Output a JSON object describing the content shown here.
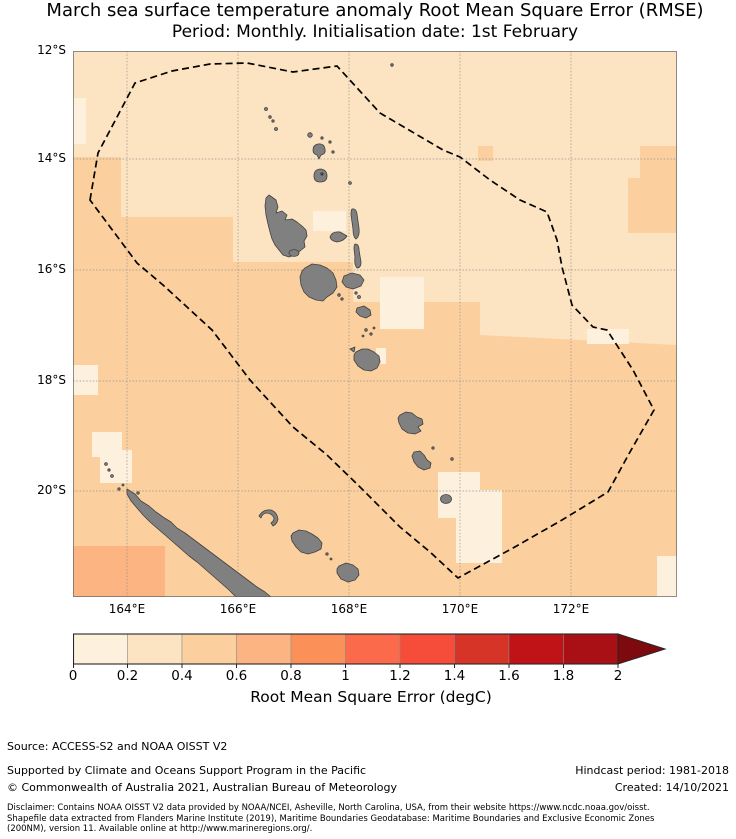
{
  "figure": {
    "title": "March sea surface temperature anomaly Root Mean Square Error (RMSE)",
    "subtitle": "Period: Monthly. Initialisation date: 1st February"
  },
  "chart_data": {
    "type": "heatmap",
    "description": "Filled gridded map of SST-anomaly hindcast RMSE (degC) around Vanuatu and New Caledonia. Land is grey; a black dashed polygon marks the Vanuatu EEZ boundary; graticule lines every 2 degrees.",
    "x_axis": {
      "label": "",
      "ticks": [
        "164°E",
        "166°E",
        "168°E",
        "170°E",
        "172°E"
      ],
      "approx_range_deg_east": [
        163.0,
        173.9
      ],
      "grid": true
    },
    "y_axis": {
      "label": "",
      "ticks": [
        "12°S",
        "14°S",
        "16°S",
        "18°S",
        "20°S"
      ],
      "approx_range_deg_south": [
        12.0,
        21.9
      ],
      "grid": true
    },
    "colorbar": {
      "label": "Root Mean Square Error (degC)",
      "tick_labels": [
        "0",
        "0.2",
        "0.4",
        "0.6",
        "0.8",
        "1",
        "1.2",
        "1.4",
        "1.6",
        "1.8",
        "2"
      ],
      "range": [
        0,
        2
      ],
      "bin_width": 0.2,
      "orientation": "horizontal",
      "extend": "max-arrow-right",
      "bin_colors": [
        "#fdf0dd",
        "#fce3c1",
        "#fbd09e",
        "#fcb483",
        "#fc9059",
        "#fb6a4a",
        "#f64d3b",
        "#d63426",
        "#c01318",
        "#a81016"
      ],
      "over_color": "#7f0a0d"
    },
    "shading_regions": [
      {
        "area": "northern and northeastern map (roughly 12-16°S, east of Vanuatu)",
        "rmse_degC": "0.2-0.4"
      },
      {
        "area": "southwestern and central-southern map (Coral Sea side, around New Caledonia and southern Vanuatu)",
        "rmse_degC": "0.4-0.6"
      },
      {
        "area": "scattered light patches (west of New Caledonia, southeast of Vanuatu chain, near Efate, far southeast corner)",
        "rmse_degC": "0-0.2"
      },
      {
        "area": "far southwest corner of map",
        "rmse_degC": "0.6-0.8"
      },
      {
        "area": "small blocks near 14°S 170°E and 14-15°S 173°E",
        "rmse_degC": "0.4-0.6"
      }
    ],
    "features": {
      "land_fill": "#808080",
      "land_outline": "#404040",
      "eez_boundary_style": "black dashed polygon",
      "eez_boundary_color": "#000000",
      "island_groups": "Vanuatu archipelago (Torres, Banks, Espiritu Santo, Maewo, Ambae, Pentecost, Malakula, Ambrym, Epi, Efate, Erromango, Tanna, Aneityum) and New Caledonia with Loyalty Islands"
    }
  },
  "footer": {
    "source": "Source: ACCESS-S2 and NOAA OISST V2",
    "supported": "Supported by Climate and Oceans Support Program in the Pacific",
    "copyright": "© Commonwealth of Australia 2021, Australian Bureau of Meteorology",
    "hindcast": "Hindcast period: 1981-2018",
    "created": "Created: 14/10/2021",
    "disclaimer_line1": "Disclaimer: Contains NOAA OISST V2 data provided by NOAA/NCEI, Asheville, North Carolina, USA, from their website https://www.ncdc.noaa.gov/oisst.",
    "disclaimer_line2": "Shapefile data extracted from Flanders Marine Institute (2019), Maritime Boundaries Geodatabase: Maritime Boundaries and Exclusive Economic Zones",
    "disclaimer_line3": "(200NM), version 11. Available online at http://www.marineregions.org/."
  }
}
